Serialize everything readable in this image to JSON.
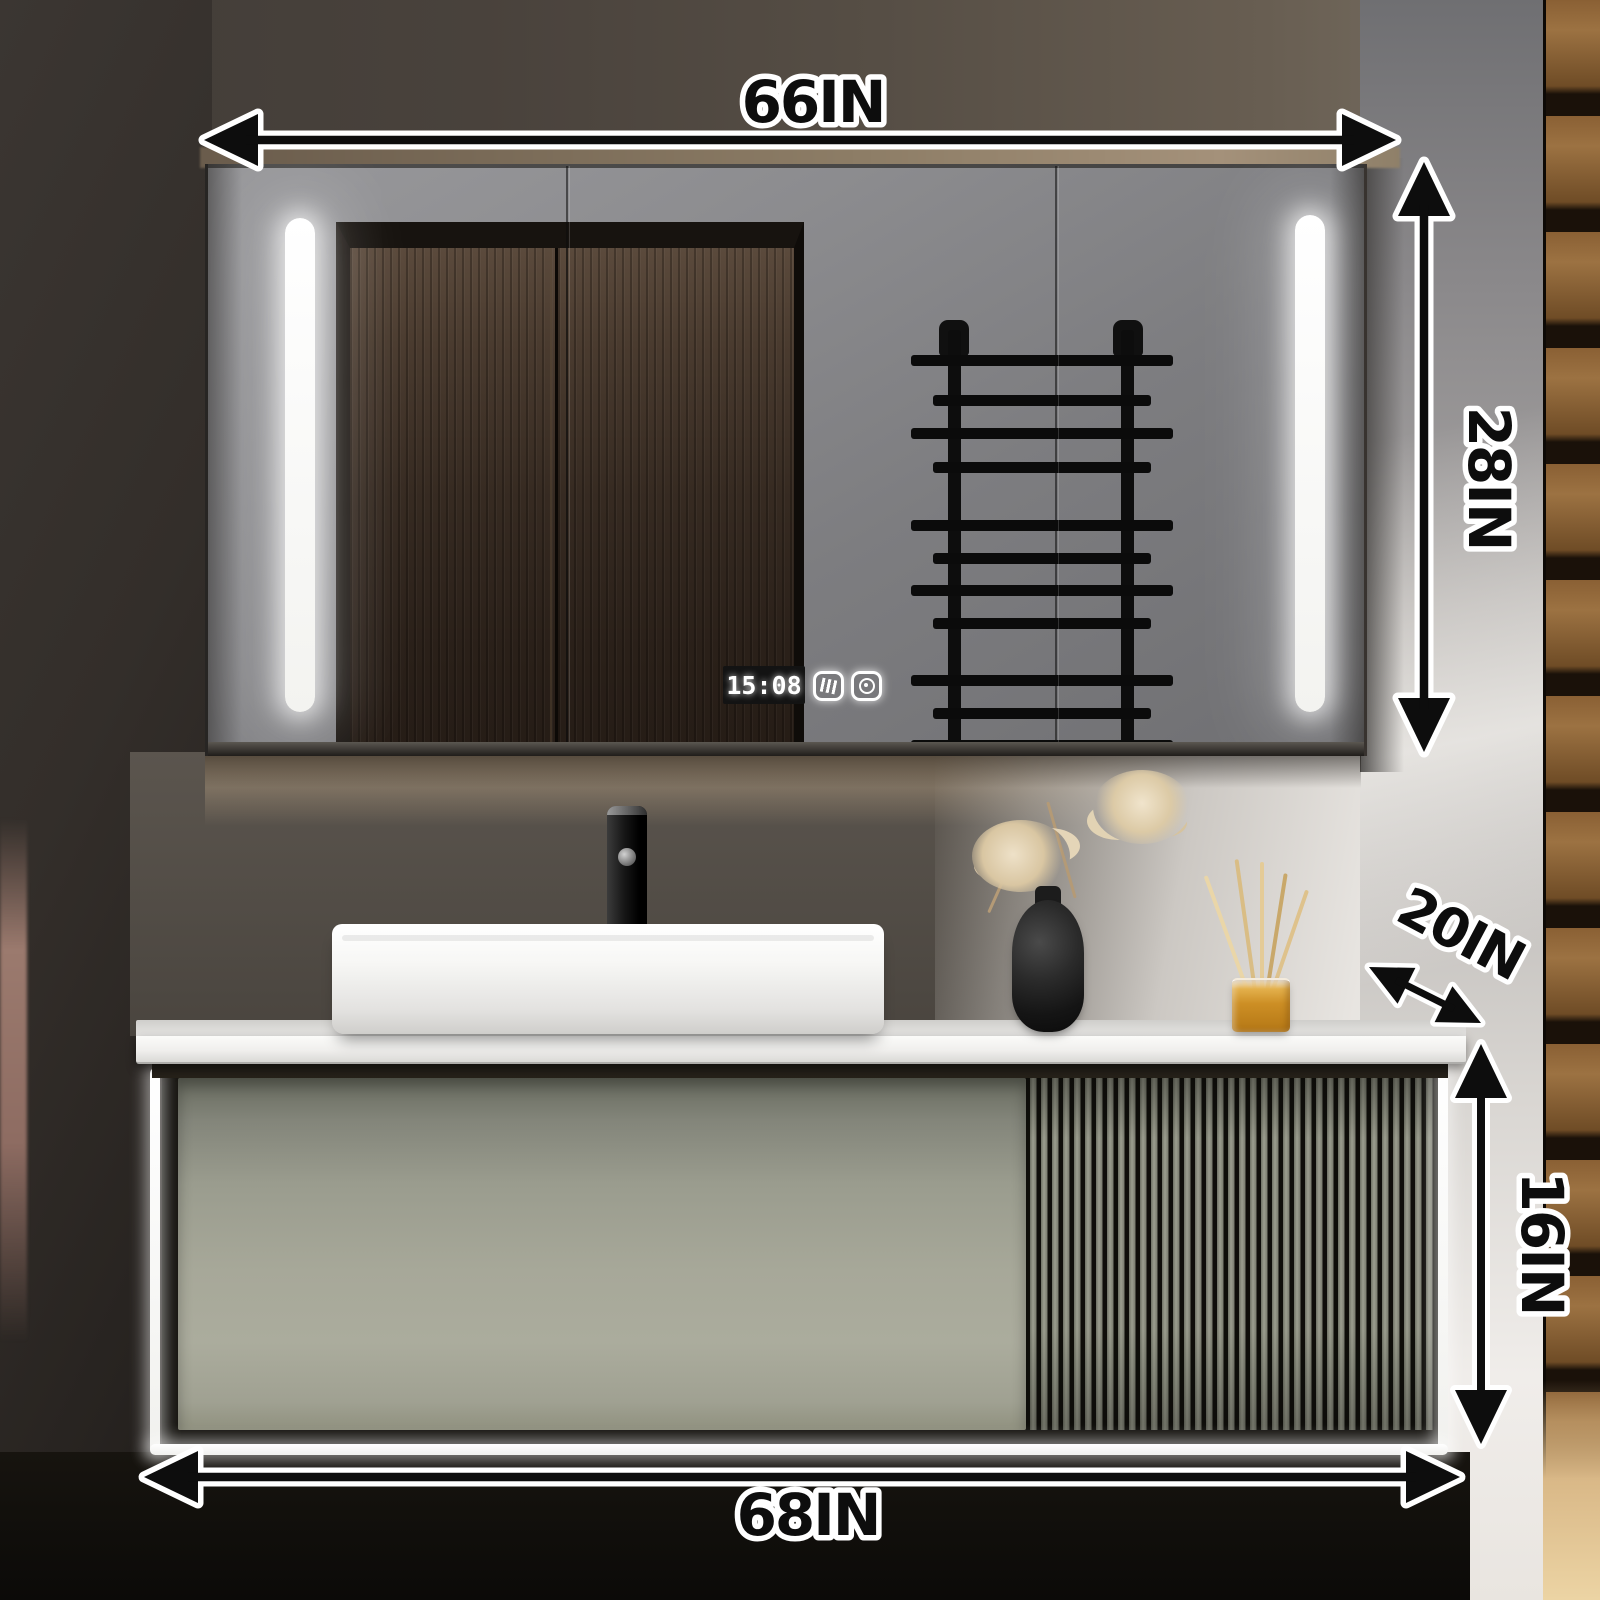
{
  "product_dimensions": {
    "mirror_cabinet_width": "66IN",
    "mirror_cabinet_height": "28IN",
    "countertop_depth": "20IN",
    "vanity_height": "16IN",
    "vanity_width": "68IN"
  },
  "mirror_display": {
    "time": "15:08",
    "touch_icons": [
      "defogger",
      "light-control"
    ]
  },
  "colors": {
    "annotation_line": "#0d0d0d",
    "annotation_outline": "#ffffff",
    "vanity_cabinet_green": "#9fa092",
    "countertop_white": "#f2f1ef",
    "led_light": "#ffffff",
    "wood_slat_panel": "#8a6034",
    "diffuser_amber": "#cd8f25",
    "wardrobe_reflection": "#3a2d23"
  }
}
